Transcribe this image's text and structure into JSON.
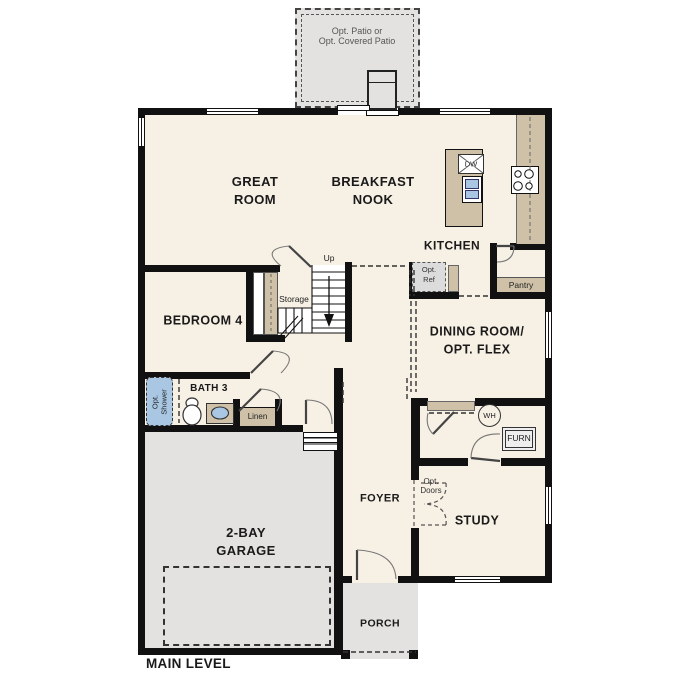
{
  "plan": {
    "title": "MAIN LEVEL"
  },
  "rooms": {
    "patio": {
      "line1": "Opt. Patio or",
      "line2": "Opt. Covered Patio"
    },
    "great_room": {
      "line1": "GREAT",
      "line2": "ROOM"
    },
    "breakfast_nook": {
      "line1": "BREAKFAST",
      "line2": "NOOK"
    },
    "kitchen": {
      "label": "KITCHEN"
    },
    "bedroom_4": {
      "label": "BEDROOM 4"
    },
    "bath_3": {
      "label": "BATH 3"
    },
    "dining_room": {
      "line1": "DINING ROOM/",
      "line2": "OPT. FLEX"
    },
    "study": {
      "label": "STUDY"
    },
    "foyer": {
      "label": "FOYER"
    },
    "garage": {
      "line1": "2-BAY",
      "line2": "GARAGE"
    },
    "porch": {
      "label": "PORCH"
    }
  },
  "features": {
    "stairs_up": "Up",
    "storage": "Storage",
    "linen": "Linen",
    "pantry": "Pantry",
    "dishwasher": "DW",
    "water_heater": "WH",
    "furnace": "FURN",
    "opt_ref": {
      "line1": "Opt.",
      "line2": "Ref"
    },
    "opt_doors": {
      "line1": "Opt.",
      "line2": "Doors"
    },
    "opt_shower": {
      "line1": "Opt.",
      "line2": "Shower"
    }
  },
  "colors": {
    "wall": "#111111",
    "floor": "#f7f0e4",
    "outdoor_gray": "#e3e2e0",
    "counter_tan": "#cec1a8",
    "plumbing_blue": "#a9c7e2",
    "label_text": "#1a1a1a",
    "secondary_text": "#555555"
  }
}
